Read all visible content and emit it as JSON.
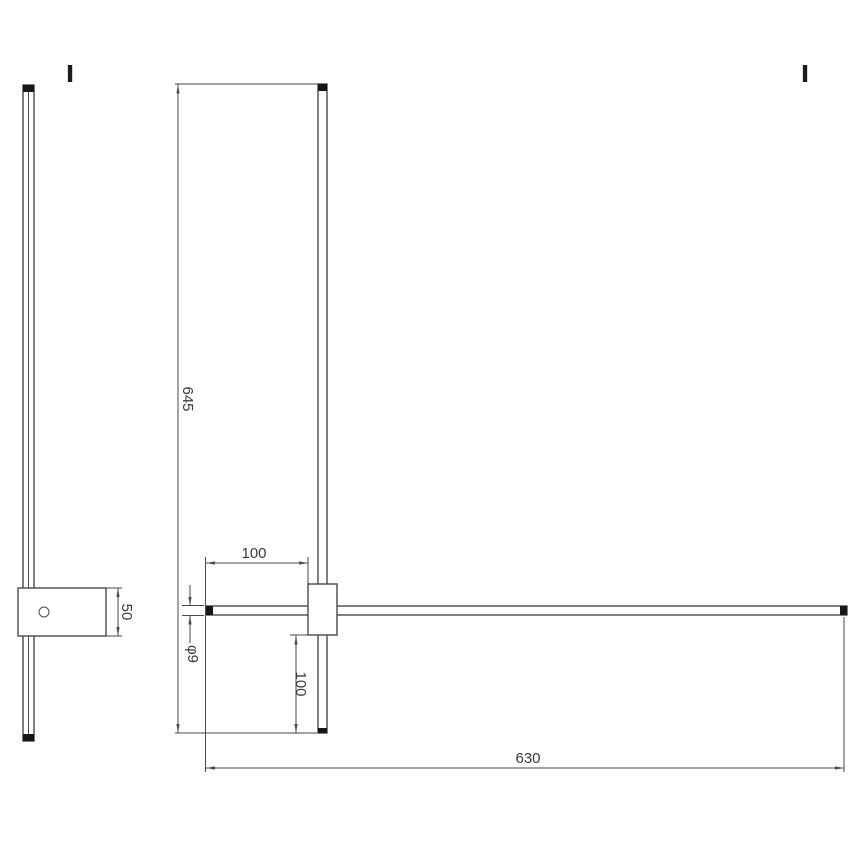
{
  "markers": {
    "left": "I",
    "right": "I"
  },
  "dims": {
    "bar_length": "645",
    "arm_offset_left": "100",
    "bar_diameter": "φ9",
    "drop_below_box": "100",
    "arm_length": "630",
    "box_height": "50"
  },
  "colors": {
    "line": "#4a4a4a",
    "text": "#3a3a3a",
    "cap": "#161616",
    "background": "#ffffff"
  }
}
